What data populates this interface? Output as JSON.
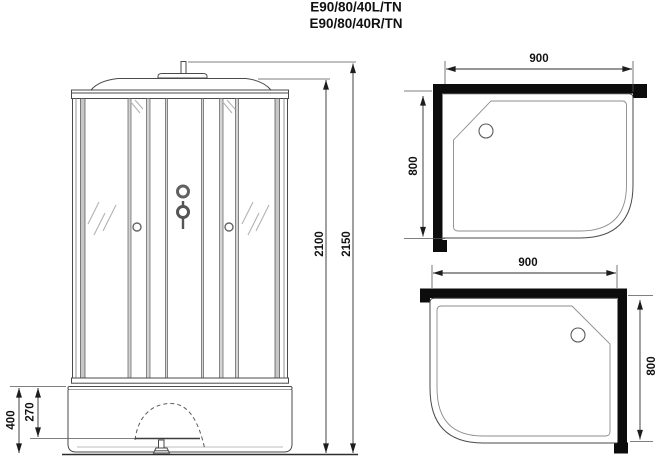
{
  "title": {
    "line1": "E90/80/40L/TN",
    "line2": "E90/80/40R/TN"
  },
  "front_view": {
    "dim_overall_height": "2150",
    "dim_cabin_height": "2100",
    "dim_tray_height": "400",
    "dim_apron_height": "270"
  },
  "plan_view_left": {
    "dim_width": "900",
    "dim_depth": "800"
  },
  "plan_view_right": {
    "dim_width": "900",
    "dim_depth": "800"
  },
  "colors": {
    "wall": "#0c0c0c",
    "line": "#4a4a4a",
    "background": "#ffffff"
  }
}
